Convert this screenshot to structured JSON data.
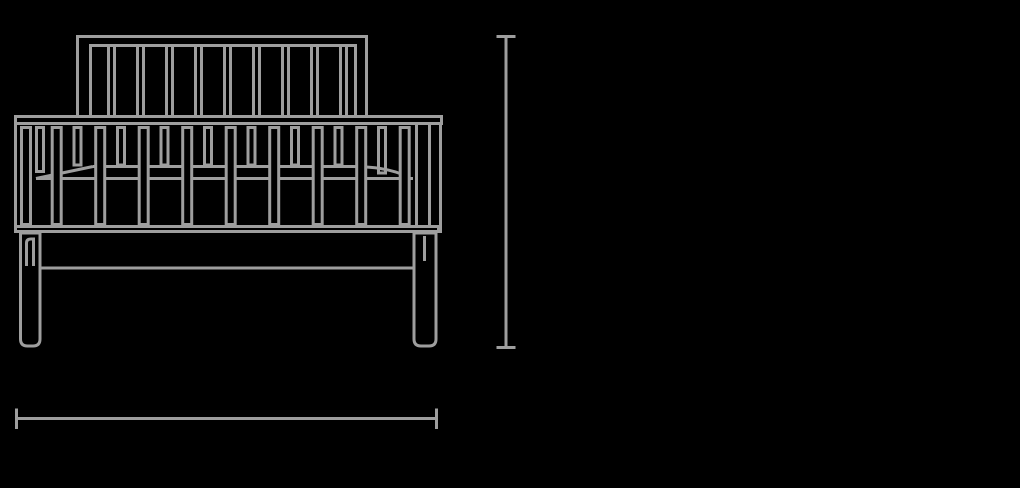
{
  "meta": {
    "subject": "crib-front-elevation-technical-drawing",
    "text_labels": []
  },
  "colors": {
    "background": "#000000",
    "line": "#9e9e9e"
  },
  "drawing": {
    "headboard": {
      "outer_path": "M77.5,118 L77.5,36.5 L366.5,36.5 L366.5,118",
      "inner_path": "M90.5,118 L90.5,45.5 L355.5,45.5 L355.5,118",
      "slats": {
        "count": 9,
        "start_x": 108.5,
        "pitch": 29,
        "line_gap": 6,
        "top": 47,
        "bottom": 118
      }
    },
    "top_rail": {
      "x": 15.5,
      "y": 116.5,
      "width": 426,
      "height": 7
    },
    "side_back_slats": {
      "y": 127.5,
      "width": 7,
      "items": [
        {
          "x": 36.5,
          "h": 44
        },
        {
          "x": 74,
          "h": 37.5
        },
        {
          "x": 117.5,
          "h": 37.5
        },
        {
          "x": 161,
          "h": 37.5
        },
        {
          "x": 204.5,
          "h": 37.5
        },
        {
          "x": 248,
          "h": 37.5
        },
        {
          "x": 291.5,
          "h": 37.5
        },
        {
          "x": 335,
          "h": 37.5
        },
        {
          "x": 378.5,
          "h": 45.5
        }
      ]
    },
    "mattress": {
      "front_edge": "M36,178.5 L413,178.5",
      "left_corner": "M36,178.5 L93,166.5",
      "back_edge": "M93,166.5 L352,166.5 C375,166.5 393,169.5 407,176.5"
    },
    "side_front_slats": {
      "y": 127.5,
      "width": 9,
      "height": 97,
      "xs": [
        21.5,
        52.2,
        95.7,
        139.2,
        182.7,
        226.2,
        269.7,
        313.2,
        356.7,
        400.2
      ]
    },
    "side_posts": {
      "left_path": "M15.5,125 L15.5,226",
      "right_path": "M416.5,125 L416.5,226 M429.5,125 L429.5,226 M440.5,125 L440.5,233"
    },
    "bottom_rail": {
      "x": 15.5,
      "y": 226.5,
      "width": 423,
      "height": 5
    },
    "apron_bottom_path": "M41.5,268 L412.5,268",
    "legs": {
      "left_path": "M20.5,233 L20.5,339 Q20.5,346 27.5,346 L33,346 Q40,346 40,339 L40,233 Z",
      "right_path": "M414,233 L414,339 Q414,346 421,346 L429,346 Q436,346 436,339 L436,233 Z",
      "left_inner_path": "M26.5,266 L26.5,243 Q26.5,239 31,239 L33.5,239 L33.5,266",
      "right_inner_path": "M424.5,261 L424.5,236"
    },
    "height_dimension": {
      "label": "",
      "line_path": "M506,36.5 L506,347.5",
      "top_cap_path": "M496.5,36.5 L515.5,36.5",
      "bottom_cap_path": "M496.5,347.5 L515.5,347.5"
    },
    "width_dimension": {
      "label": "",
      "line_path": "M16.5,418.5 L436.5,418.5",
      "left_cap_path": "M16.5,408.5 L16.5,429",
      "right_cap_path": "M436.5,408.5 L436.5,429"
    }
  }
}
